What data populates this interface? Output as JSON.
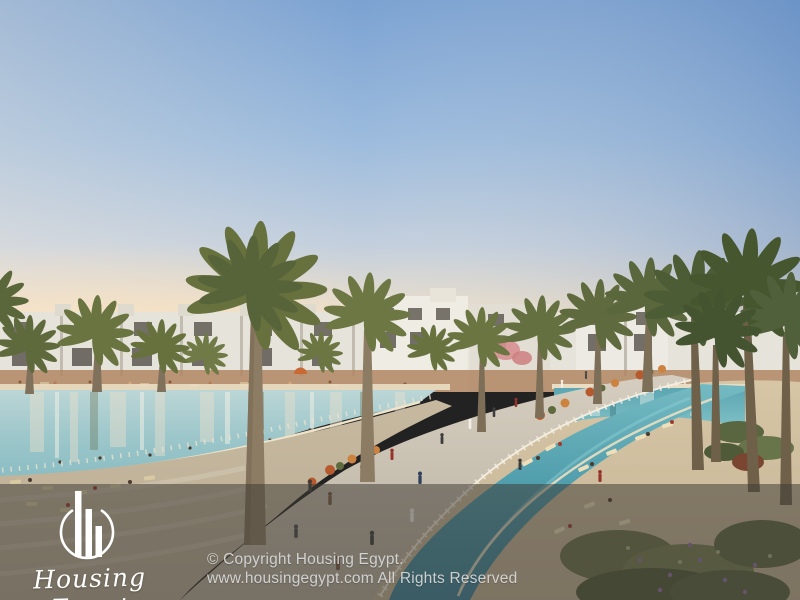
{
  "watermark": {
    "brand_script": "Housing Egypt",
    "logo_icon": "building-bars-circle-icon",
    "copyright_line1": "© Copyright Housing Egypt.",
    "copyright_line2": "www.housingegypt.com All Rights Reserved"
  },
  "scene": {
    "description": "Render of a resort compound: turquoise lagoons, palm-lined curving promenade bridge, white low-rise townhouses on the horizon, sandy beaches with sun loungers and people",
    "palette": {
      "sky_top": "#7ba2d2",
      "sky_horizon": "#f3e6ce",
      "water_lagoon_left": "#9cc6ca",
      "water_canal": "#4695a6",
      "sand": "#d0c1a2",
      "palm_green": "#5f6b3e",
      "building_white": "#eceae2",
      "promenade": "#c9c1b1",
      "overlay": "rgba(62,58,52,0.52)",
      "text_light": "#dadada"
    }
  }
}
